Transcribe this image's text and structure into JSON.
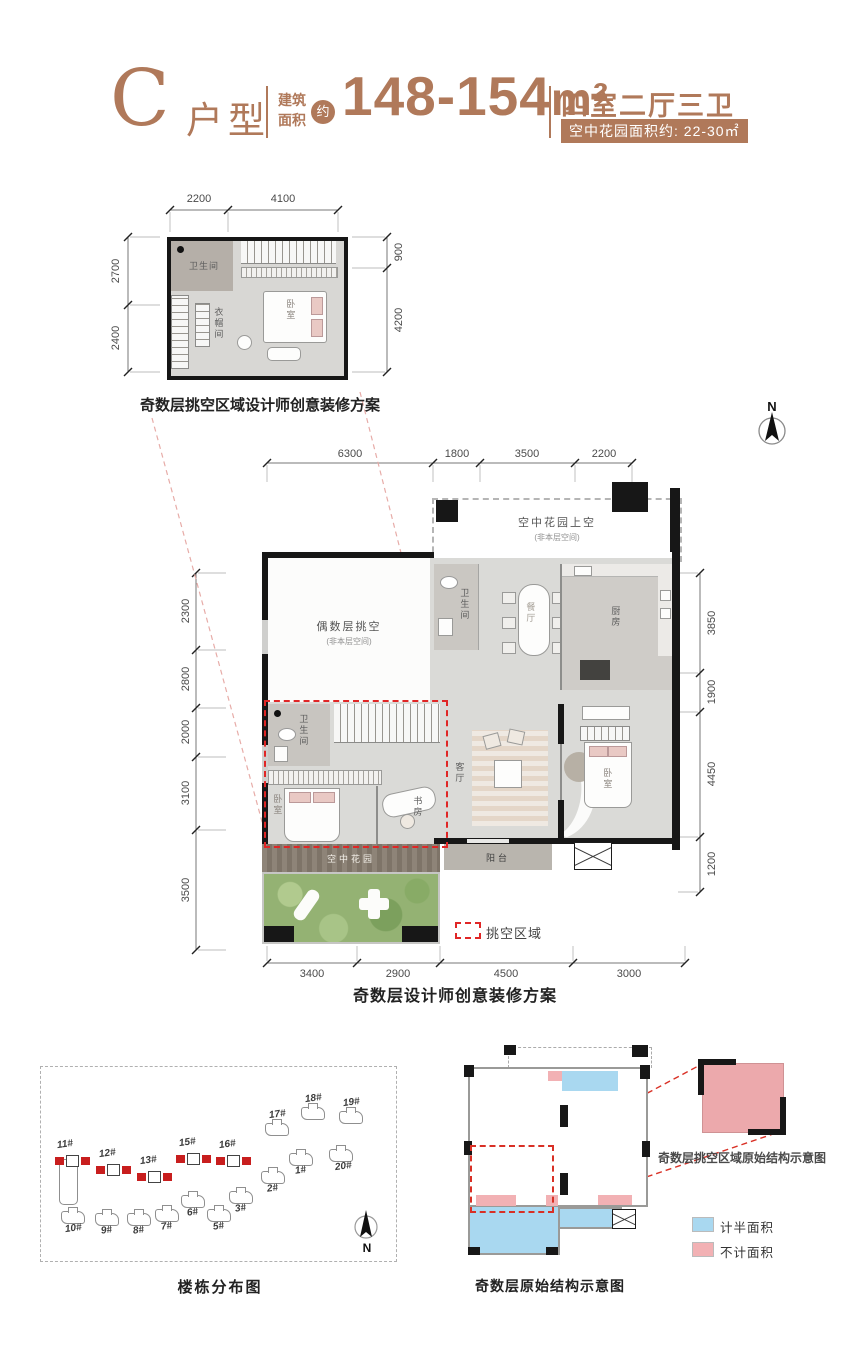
{
  "header": {
    "type_letter": "C",
    "type_suffix": "户型",
    "area_label_top": "建筑",
    "area_label_bottom": "面积",
    "approx_badge": "约",
    "area_value": "148-154",
    "area_unit": "m²",
    "layout_text": "四室二厅三卫",
    "garden_badge": "空中花园面积约: 22-30㎡",
    "accent_color": "#b0795a"
  },
  "north_label": "N",
  "upper_plan": {
    "caption": "奇数层挑空区域设计师创意装修方案",
    "dims_top": [
      "2200",
      "4100"
    ],
    "dims_left": [
      "2700",
      "2400"
    ],
    "dims_right": [
      "900",
      "4200"
    ],
    "rooms": {
      "bathroom": "卫生间",
      "cloakroom": "衣帽间",
      "bedroom": "卧室"
    }
  },
  "main_plan": {
    "caption": "奇数层设计师创意装修方案",
    "dims_top": [
      "6300",
      "1800",
      "3500",
      "2200"
    ],
    "dims_left": [
      "2300",
      "2800",
      "2000",
      "3100",
      "3500"
    ],
    "dims_right": [
      "3850",
      "1900",
      "4450",
      "1200"
    ],
    "dims_bottom": [
      "3400",
      "2900",
      "4500",
      "3000"
    ],
    "rooms": {
      "sky_garden_above": "空中花园上空",
      "sky_garden_above_note": "(非本层空间)",
      "double_height": "偶数层挑空",
      "double_height_note": "(非本层空间)",
      "dining": "餐厅",
      "kitchen": "厨房",
      "bathroom_upper": "卫生间",
      "living": "客厅",
      "bedroom_right": "卧室",
      "bathroom_lower": "卫生间",
      "bedroom_left": "卧室",
      "study": "书房",
      "balcony": "阳台",
      "sky_garden": "空中花园"
    },
    "legend_void_label": "挑空区域"
  },
  "site_plan": {
    "caption": "楼栋分布图",
    "highlighted_buildings": [
      "11#",
      "12#",
      "13#",
      "15#",
      "16#"
    ],
    "buildings": [
      "10#",
      "9#",
      "8#",
      "7#",
      "6#",
      "5#",
      "3#",
      "2#",
      "1#",
      "17#",
      "18#",
      "19#",
      "20#"
    ]
  },
  "structure_plan": {
    "caption": "奇数层原始结构示意图",
    "detail_label": "奇数层挑空区域原始结构示意图",
    "legend_half": "计半面积",
    "legend_excluded": "不计面积",
    "half_color": "#a9d8f0",
    "excluded_color": "#f2b1b4"
  }
}
